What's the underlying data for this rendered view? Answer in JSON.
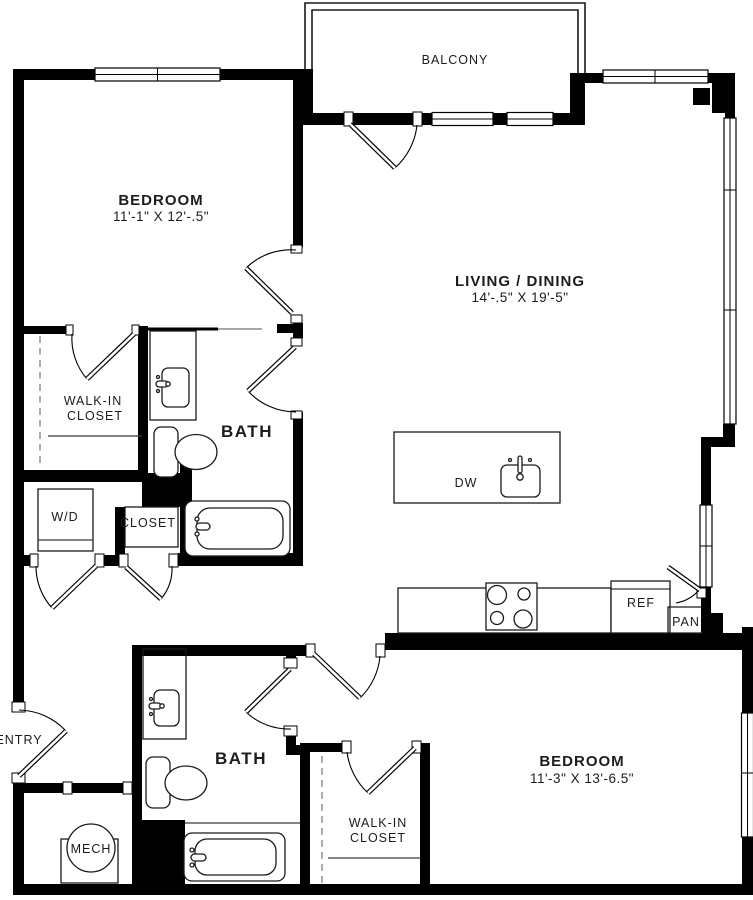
{
  "rooms": {
    "balcony": {
      "label": "BALCONY"
    },
    "bedroom_top": {
      "label": "BEDROOM",
      "dimensions": "11'-1\" X 12'-.5\""
    },
    "living_dining": {
      "label": "LIVING / DINING",
      "dimensions": "14'-.5\" X 19'-5\""
    },
    "walk_in_closet_top": {
      "label_line1": "WALK-IN",
      "label_line2": "CLOSET"
    },
    "bath_top": {
      "label": "BATH"
    },
    "laundry": {
      "label": "W/D"
    },
    "hall_closet": {
      "label": "CLOSET"
    },
    "entry": {
      "label": "ENTRY"
    },
    "mech": {
      "label": "MECH"
    },
    "bath_bottom": {
      "label": "BATH"
    },
    "walk_in_closet_bottom": {
      "label_line1": "WALK-IN",
      "label_line2": "CLOSET"
    },
    "bedroom_bottom": {
      "label": "BEDROOM",
      "dimensions": "11'-3\" X 13'-6.5\""
    }
  },
  "kitchen": {
    "dishwasher_label": "DW",
    "refrigerator_label": "REF",
    "pantry_label": "PAN"
  },
  "colors": {
    "walls": "#000000",
    "background": "#ffffff",
    "text": "#1c1c1c"
  }
}
